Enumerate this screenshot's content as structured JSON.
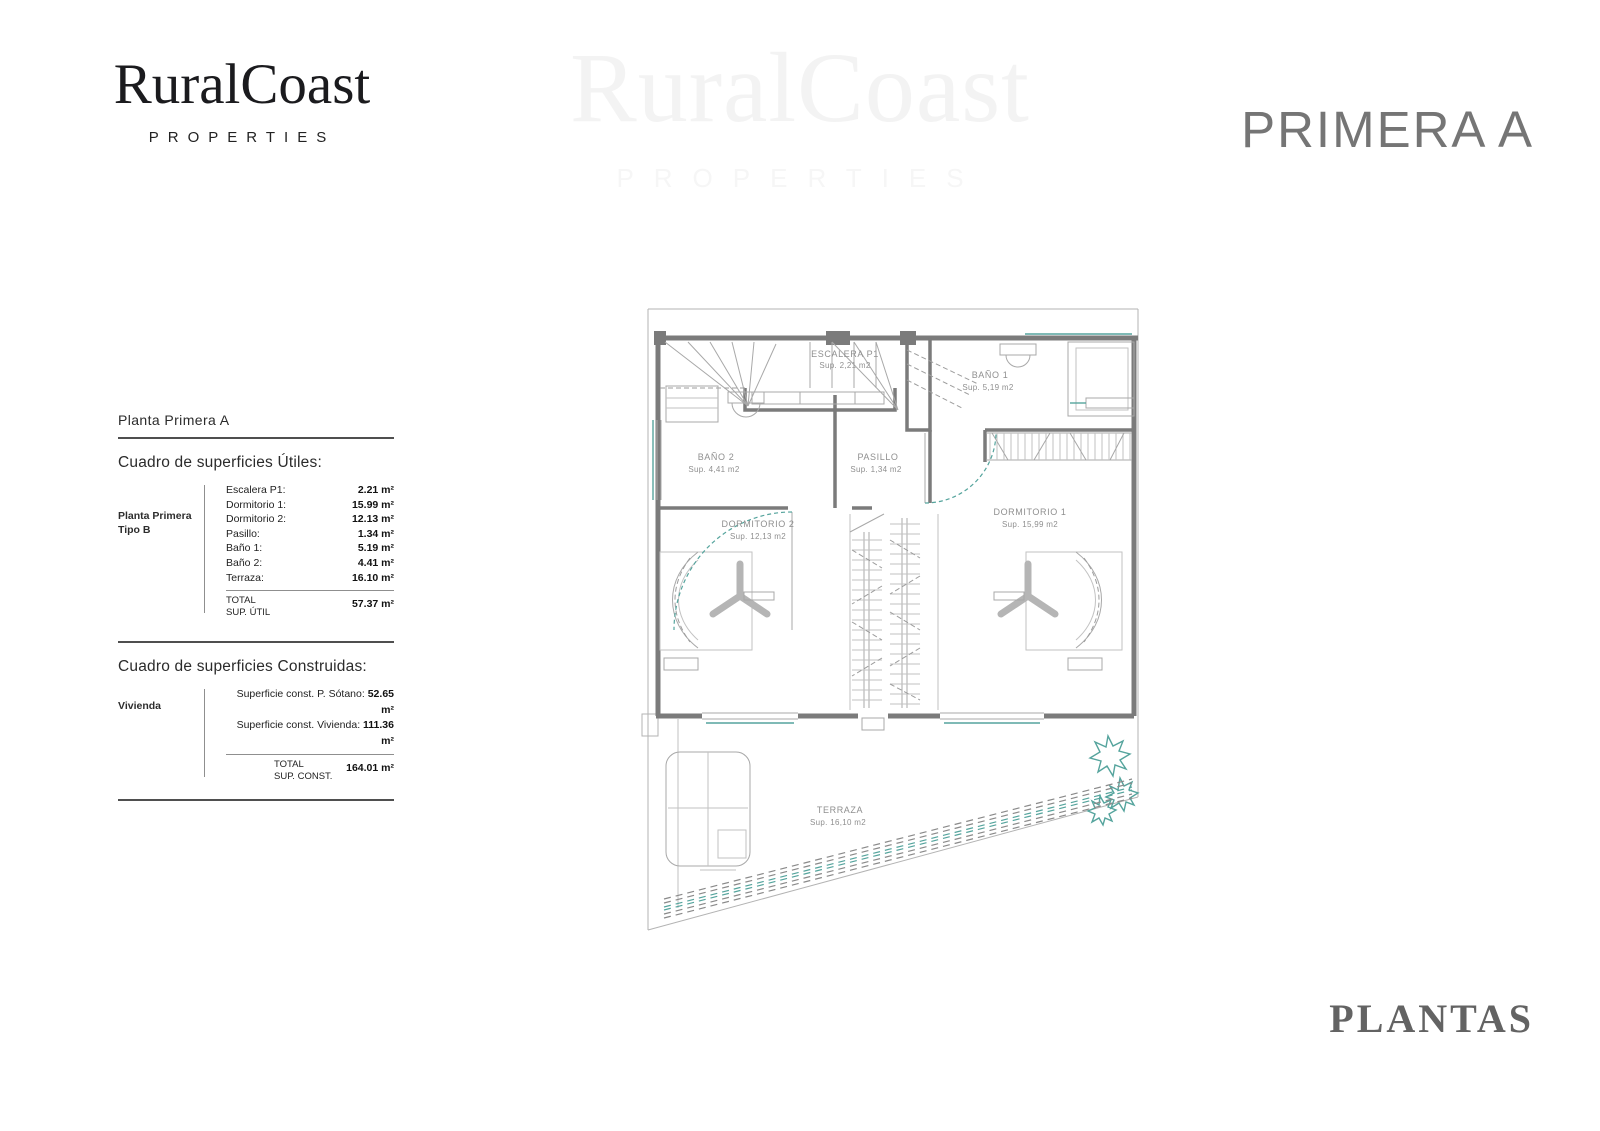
{
  "brand": {
    "name": "RuralCoast",
    "tagline": "PROPERTIES"
  },
  "watermark": {
    "name": "RuralCoast",
    "tagline": "PROPERTIES"
  },
  "header": {
    "title": "PRIMERA A"
  },
  "footer": {
    "title": "PLANTAS"
  },
  "surfaces": {
    "plan_title": "Planta Primera A",
    "utiles": {
      "heading": "Cuadro de superficies Útiles:",
      "group_line1": "Planta Primera",
      "group_line2": "Tipo B",
      "rows": [
        {
          "label": "Escalera P1:",
          "value": "2.21 m²"
        },
        {
          "label": "Dormitorio 1:",
          "value": "15.99 m²"
        },
        {
          "label": "Dormitorio 2:",
          "value": "12.13 m²"
        },
        {
          "label": "Pasillo:",
          "value": "1.34 m²"
        },
        {
          "label": "Baño 1:",
          "value": "5.19 m²"
        },
        {
          "label": "Baño 2:",
          "value": "4.41 m²"
        },
        {
          "label": "Terraza:",
          "value": "16.10 m²"
        }
      ],
      "total_label": "TOTAL",
      "total_sublabel": "SUP. ÚTIL",
      "total_value": "57.37 m²"
    },
    "construidas": {
      "heading": "Cuadro de superficies Construidas:",
      "group_line1": "Vivienda",
      "rows": [
        {
          "label": "Superficie const. P. Sótano:",
          "value": "52.65 m²"
        },
        {
          "label": "Superficie const. Vivienda:",
          "value": "111.36 m²"
        }
      ],
      "total_label": "TOTAL",
      "total_sublabel": "SUP. CONST.",
      "total_value": "164.01 m²"
    }
  },
  "floorplan": {
    "rooms": {
      "escalera": {
        "name": "ESCALERA P1",
        "area": "Sup. 2,21 m2"
      },
      "bano1": {
        "name": "BAÑO 1",
        "area": "Sup. 5,19 m2"
      },
      "bano2": {
        "name": "BAÑO 2",
        "area": "Sup. 4,41 m2"
      },
      "pasillo": {
        "name": "PASILLO",
        "area": "Sup. 1,34 m2"
      },
      "dormitorio2": {
        "name": "DORMITORIO 2",
        "area": "Sup. 12,13 m2"
      },
      "dormitorio1": {
        "name": "DORMITORIO 1",
        "area": "Sup. 15,99 m2"
      },
      "terraza": {
        "name": "TERRAZA",
        "area": "Sup. 16,10 m2"
      }
    },
    "colors": {
      "wall": "#7b7b7b",
      "line": "#a8a8a8",
      "accent": "#55a49d",
      "label": "#8f8f8f"
    }
  }
}
